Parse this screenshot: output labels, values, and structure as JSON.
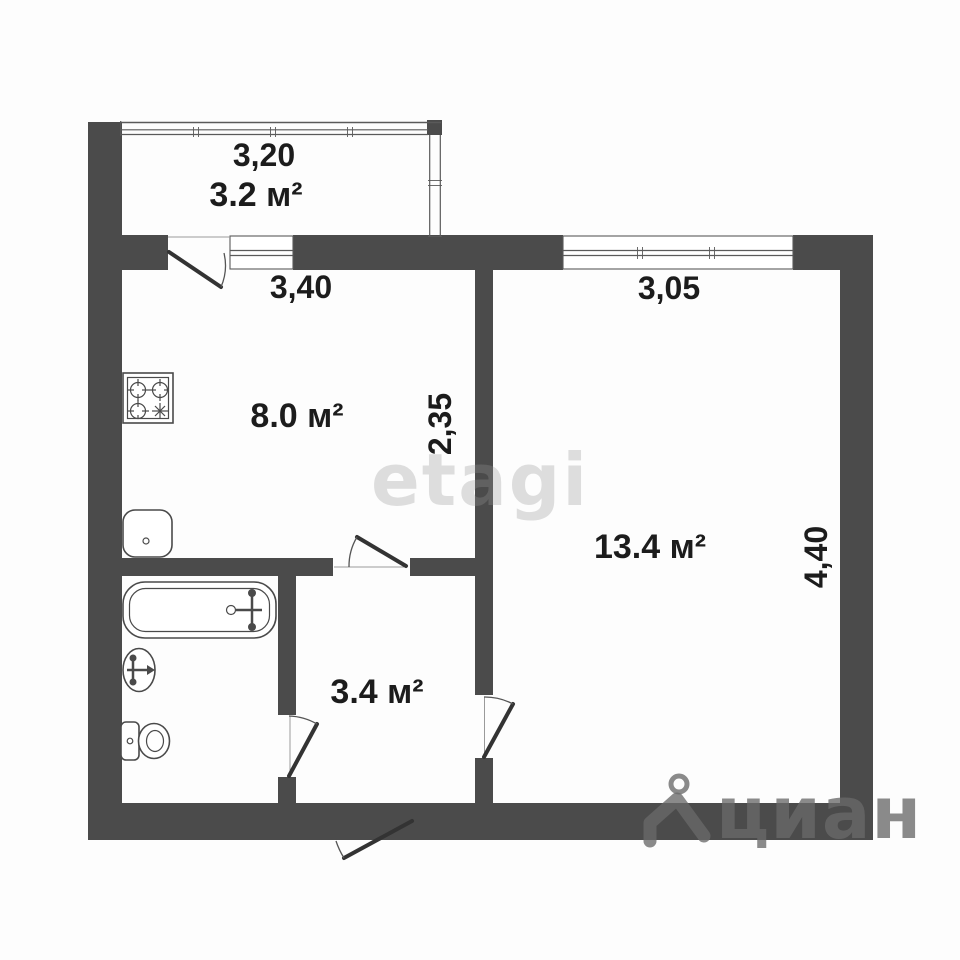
{
  "plan": {
    "balcony": {
      "width_label": "3,20",
      "area_label": "3.2 м²"
    },
    "kitchen": {
      "width_label": "3,40",
      "depth_label": "2,35",
      "area_label": "8.0 м²"
    },
    "living_room": {
      "width_label": "3,05",
      "depth_label": "4,40",
      "area_label": "13.4 м²"
    },
    "hallway": {
      "area_label": "3.4 м²"
    }
  },
  "watermarks": {
    "center": "etagi",
    "corner": "циан"
  },
  "colors": {
    "wall": "#4b4b4b",
    "line": "#4a4a4a",
    "text": "#1c1c1c"
  }
}
